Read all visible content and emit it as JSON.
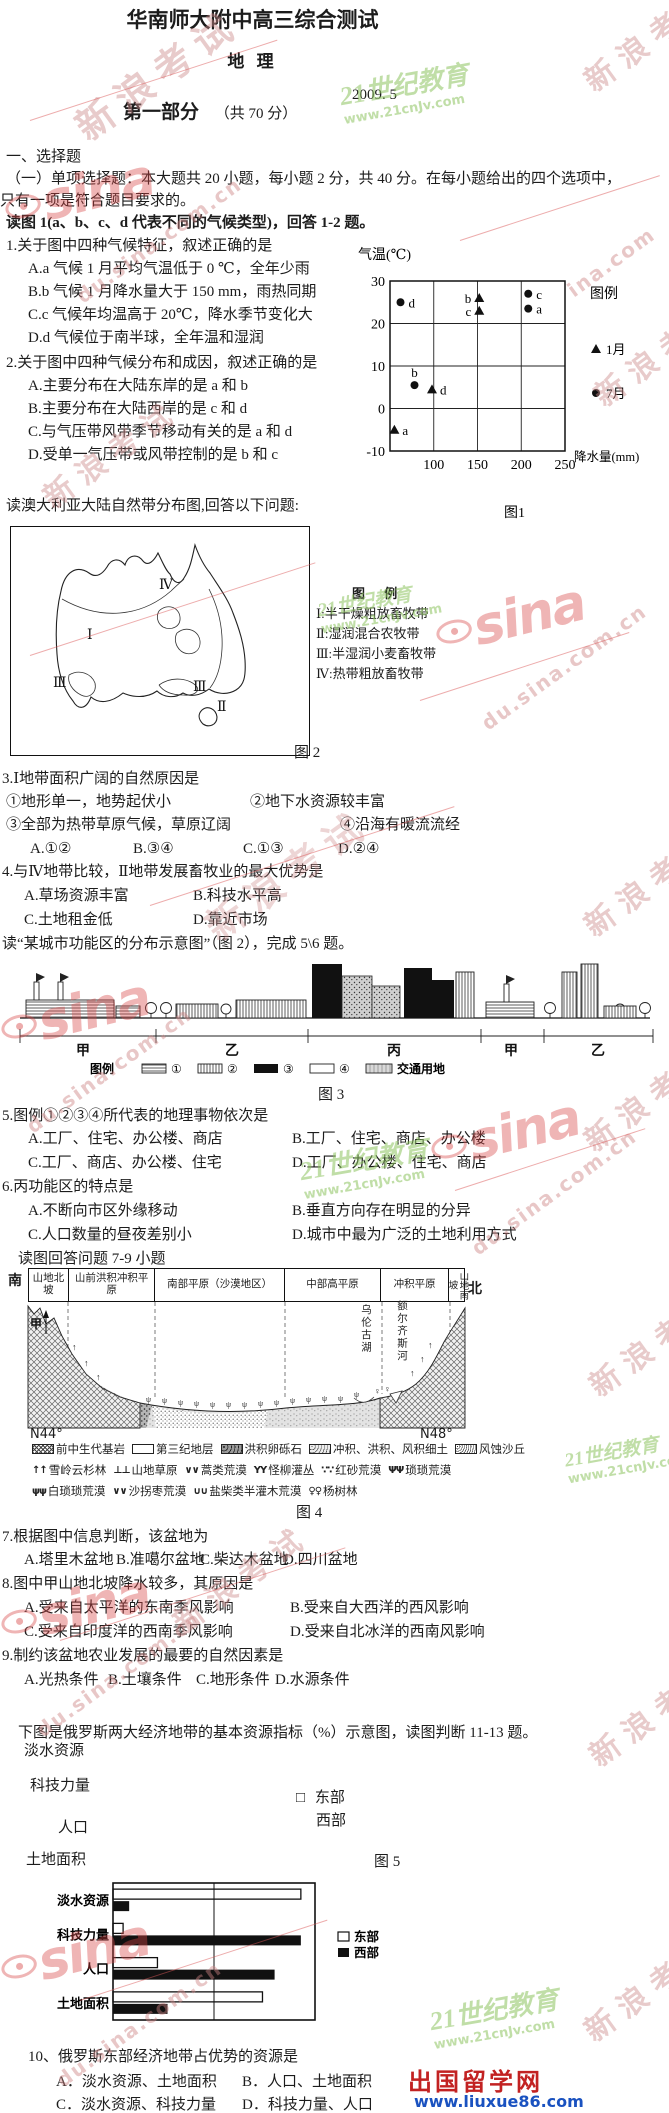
{
  "wm": {
    "sina": "sina",
    "cjk": "新浪考试",
    "cjk_part": "新浪考",
    "url_edu": "edu.sina.com.cn",
    "url_du": "du.sina.com.cn",
    "url_part": "ina.com",
    "green_name": "21世纪教育",
    "green_url": "www.21cnJv.com"
  },
  "header": {
    "title": "华南师大附中高三综合测试",
    "subject": "地 理",
    "date": "2009. 5",
    "part_title": "第一部分",
    "part_score": "（共 70 分）"
  },
  "intro": {
    "section": "一、选择题",
    "line1": "（一）单项选择题：本大题共 20 小题，每小题 2 分，共 40 分。在每小题给出的四个选项中，",
    "line2": "只有一项是符合题目要求的。",
    "fig1_prompt": "读图 1(a、b、c、d 代表不同的气候类型)，回答 1-2 题。"
  },
  "q1": {
    "stem": "1.关于图中四种气候特征，叙述正确的是",
    "a": "A.a 气候 1 月平均气温低于 0 ℃，全年少雨",
    "b": "B.b 气候 1 月降水量大于 150 mm，雨热同期",
    "c": "C.c 气候年均温高于 20℃，降水季节变化大",
    "d": "D.d 气候位于南半球，全年温和湿润"
  },
  "q2": {
    "stem": "2.关于图中四种气候分布和成因，叙述正确的是",
    "a": "A.主要分布在大陆东岸的是 a 和 b",
    "b": "B.主要分布在大陆西岸的是 c 和 d",
    "c": "C.与气压带风带季节移动有关的是 a 和 d",
    "d": "D.受单一气压带或风带控制的是 b 和 c"
  },
  "fig2": {
    "prompt": "读澳大利亚大陆自然带分布图,回答以下问题:",
    "legend_title": "图 例",
    "items": [
      "Ⅰ:半干燥粗放畜牧带",
      "Ⅱ:湿润混合农牧带",
      "Ⅲ:半湿润小麦畜牧带",
      "Ⅳ:热带粗放畜牧带"
    ],
    "zones": {
      "iv": "Ⅳ",
      "i": "Ⅰ",
      "iii_sw": "Ⅲ",
      "iii_s": "Ⅲ",
      "ii": "Ⅱ"
    },
    "caption": "图 2"
  },
  "q3": {
    "stem": "3.Ⅰ地带面积广阔的自然原因是",
    "o1": "①地形单一，地势起伏小",
    "o2": "②地下水资源较丰富",
    "o3": "③全部为热带草原气候，草原辽阔",
    "o4": "④沿海有暖流流经",
    "a": "A.①②",
    "b": "B.③④",
    "c": "C.①③",
    "d": "D.②④"
  },
  "q4": {
    "stem": "4.与Ⅳ地带比较，Ⅱ地带发展畜牧业的最大优势是",
    "a": "A.草场资源丰富",
    "b": "B.科技水平高",
    "c": "C.土地租金低",
    "d": "D.靠近市场"
  },
  "fig3": {
    "prompt": "读“某城市功能区的分布示意图”（图 2），完成 5\\6 题。",
    "zones": [
      "甲",
      "乙",
      "丙",
      "甲",
      "乙"
    ],
    "legend_title": "图例",
    "legend_items": [
      "①",
      "②",
      "③",
      "④"
    ],
    "legend_traffic": "交通用地",
    "caption": "图 3"
  },
  "q5": {
    "stem": "5.图例①②③④所代表的地理事物依次是",
    "a": "A.工厂、住宅、办公楼、商店",
    "b": "B.工厂、住宅、商店、办公楼",
    "c": "C.工厂、商店、办公楼、住宅",
    "d": "D.工厂、办公楼、住宅、商店"
  },
  "q6": {
    "stem": "6.丙功能区的特点是",
    "a": "A.不断向市区外缘移动",
    "b": "B.垂直方向存在明显的分异",
    "c": "C.人口数量的昼夜差别小",
    "d": "D.城市中最为广泛的土地利用方式"
  },
  "fig4": {
    "prompt": "读图回答问题 7-9 小题",
    "south": "南",
    "north": "北",
    "columns": [
      "山地北坡",
      "山前洪积冲积平原",
      "南部平原（沙漠地区）",
      "中部高平原",
      "冲积平原",
      "山地南坡"
    ],
    "jia": "甲",
    "lake": "乌伦古湖",
    "river": "额尔齐斯河",
    "lat_left": "N44°",
    "lat_right": "N48°",
    "legend_row1": [
      "前中生代基岩",
      "第三纪地层",
      "洪积卵砾石",
      "冲积、洪积、风积细土",
      "风蚀沙丘"
    ],
    "legend_row2": [
      {
        "sym": "↑↑",
        "label": "雪岭云杉林"
      },
      {
        "sym": "⊥⊥",
        "label": "山地草原"
      },
      {
        "sym": "∨∨",
        "label": "蒿类荒漠"
      },
      {
        "sym": "ΥΥ",
        "label": "怪柳灌丛"
      },
      {
        "sym": "∵∵",
        "label": "红砂荒漠"
      },
      {
        "sym": "ΨΨ",
        "label": "琐琐荒漠"
      }
    ],
    "legend_row3": [
      {
        "sym": "ψψ",
        "label": "白琐琐荒漠"
      },
      {
        "sym": "∨∨",
        "label": "沙拐枣荒漠"
      },
      {
        "sym": "∪∪",
        "label": "盐柴类半灌木荒漠"
      },
      {
        "sym": "♀♀",
        "label": "杨树林"
      }
    ],
    "caption": "图 4"
  },
  "q7": {
    "stem": "7.根据图中信息判断，该盆地为",
    "a": "A.塔里木盆地",
    "b": "B.准噶尔盆地",
    "c": "C.柴达木盆地",
    "d": "D.四川盆地"
  },
  "q8": {
    "stem": "8.图中甲山地北坡降水较多，其原因是",
    "a": "A.受来自太平洋的东南季风影响",
    "b": "B.受来自大西洋的西风影响",
    "c": "C.受来自印度洋的西南季风影响",
    "d": "D.受来自北冰洋的西南风影响"
  },
  "q9": {
    "stem": "9.制约该盆地农业发展的最要的自然因素是",
    "a": "A.光热条件",
    "b": "B.土壤条件",
    "c": "C.地形条件",
    "d": "D.水源条件"
  },
  "fig5": {
    "prompt": "下图是俄罗斯两大经济地带的基本资源指标（%）示意图，读图判断 11-13 题。",
    "ghost_labels": [
      "淡水资源",
      "科技力量",
      "人口",
      "土地面积"
    ],
    "legend_box": "□",
    "legend_east": "东部",
    "legend_west": "西部",
    "caption": "图 5"
  },
  "q10": {
    "stem": "10、俄罗斯东部经济地带占优势的资源是",
    "a": "A．淡水资源、土地面积",
    "b": "B．人口、土地面积",
    "c": "C．淡水资源、科技力量",
    "d": "D．科技力量、人口"
  },
  "footer": {
    "site_name": "出国留学网",
    "site_url": "www.liuxue86.com"
  },
  "chart_data": [
    {
      "id": "fig1",
      "type": "scatter",
      "caption": "图1",
      "xlabel": "降水量(mm)",
      "ylabel": "气温(℃)",
      "xlim": [
        50,
        250
      ],
      "ylim": [
        -10,
        30
      ],
      "xticks": [
        100,
        150,
        200,
        250
      ],
      "yticks": [
        30,
        20,
        10,
        0,
        -10
      ],
      "legend_title": "图例",
      "legend": [
        {
          "marker": "triangle",
          "label": "1月"
        },
        {
          "marker": "circle",
          "label": "7月"
        }
      ],
      "points": [
        {
          "label": "d",
          "marker": "circle",
          "x": 62,
          "y": 25,
          "side": "right"
        },
        {
          "label": "b",
          "marker": "triangle",
          "x": 152,
          "y": 26,
          "side": "left"
        },
        {
          "label": "c",
          "marker": "triangle",
          "x": 152,
          "y": 23,
          "side": "left"
        },
        {
          "label": "c",
          "marker": "circle",
          "x": 208,
          "y": 27,
          "side": "right"
        },
        {
          "label": "a",
          "marker": "circle",
          "x": 208,
          "y": 23.5,
          "side": "right"
        },
        {
          "label": "b",
          "marker": "circle",
          "x": 78,
          "y": 5.5,
          "side": "top"
        },
        {
          "label": "d",
          "marker": "triangle",
          "x": 98,
          "y": 4.5,
          "side": "right"
        },
        {
          "label": "a",
          "marker": "triangle",
          "x": 55,
          "y": -5,
          "side": "right"
        }
      ]
    },
    {
      "id": "fig5",
      "type": "bar",
      "title": "俄罗斯两大经济地带的基本资源指标（%）",
      "categories": [
        "淡水资源",
        "科技力量",
        "人口",
        "土地面积"
      ],
      "series": [
        {
          "name": "东部",
          "fill": "white",
          "values": [
            93,
            5,
            22,
            74
          ]
        },
        {
          "name": "西部",
          "fill": "black",
          "values": [
            8,
            93,
            80,
            27
          ]
        }
      ],
      "xlim": [
        0,
        100
      ],
      "legend_position": "right",
      "grid": "center-line"
    }
  ]
}
